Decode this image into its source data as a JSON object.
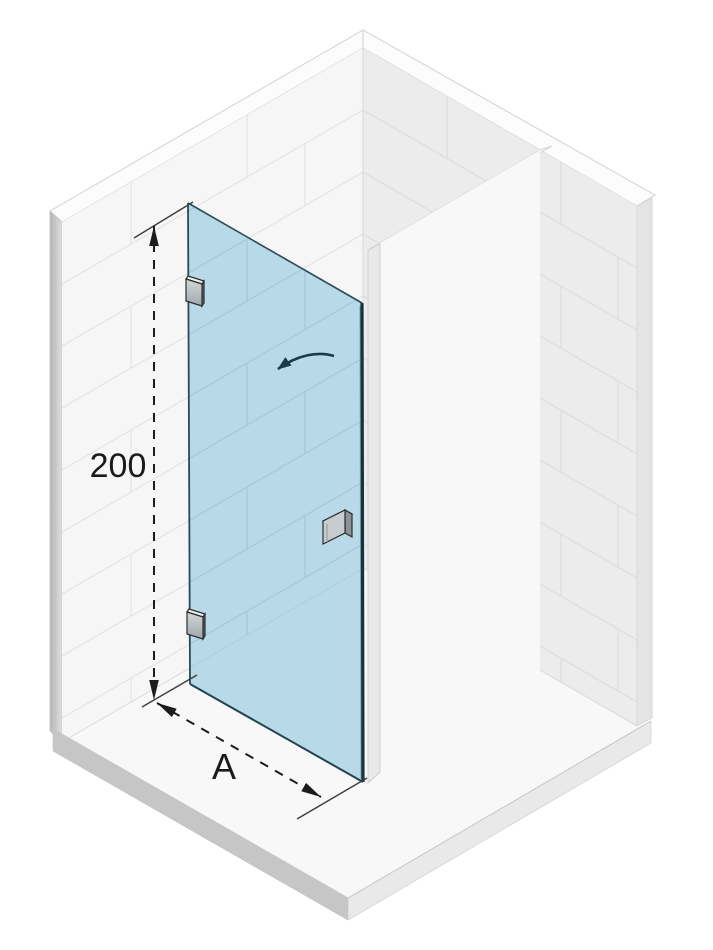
{
  "diagram": {
    "type": "shower-door-installation-isometric",
    "labels": {
      "height": "200",
      "width": "A"
    },
    "door": {
      "hinge_count": 2,
      "handle_count": 1,
      "swing": "opens-inward-left"
    },
    "colors": {
      "glass": "#b8d9e8",
      "glass_edge": "#16323f",
      "glass_tile_line": "#a6c8da",
      "dimension": "#1c1c1c",
      "arrow": "#1c3a49",
      "wall_left": "#f6f6f6",
      "wall_right": "#ececec",
      "tile_line": "#e4e4e4",
      "tile_line_right": "#dddddd",
      "floor": "#f8f8f8",
      "slab_left": "#c6c6c6",
      "slab_right": "#e9e9e9",
      "partition": "#f8f8f8"
    }
  }
}
